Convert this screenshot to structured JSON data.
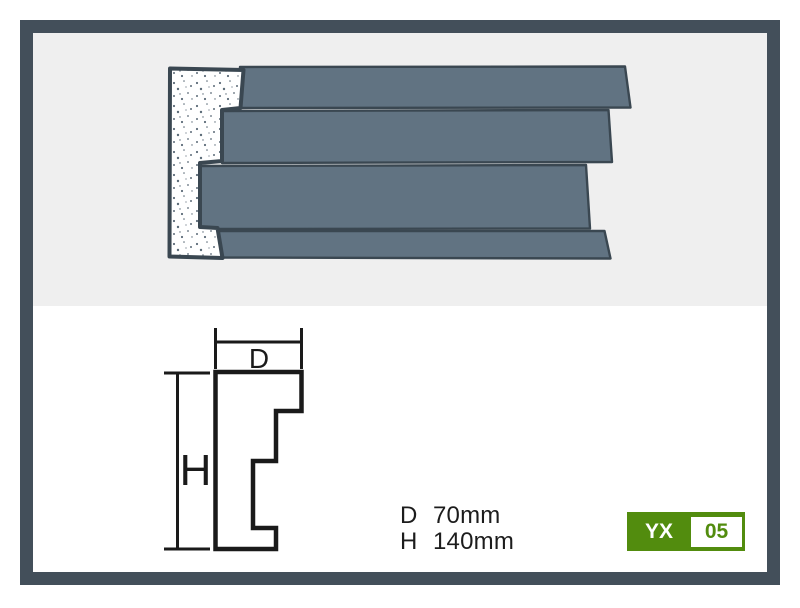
{
  "drawing": {
    "depth_label": "D",
    "height_label": "H"
  },
  "specs": {
    "rows": [
      {
        "label": "D",
        "value": "70mm"
      },
      {
        "label": "H",
        "value": "140mm"
      }
    ]
  },
  "badge": {
    "series": "YX",
    "number": "05"
  },
  "colors": {
    "frame": "#434f5a",
    "render_background": "#efefef",
    "panel_background": "#ffffff",
    "profile_fill": "#617382",
    "profile_outline": "#3a4751",
    "foam_dot": "#5c6b78",
    "drawing_line": "#1a1a1a",
    "text": "#1c1c1c",
    "badge_green": "#528c0e",
    "badge_number_bg": "#ffffff"
  }
}
